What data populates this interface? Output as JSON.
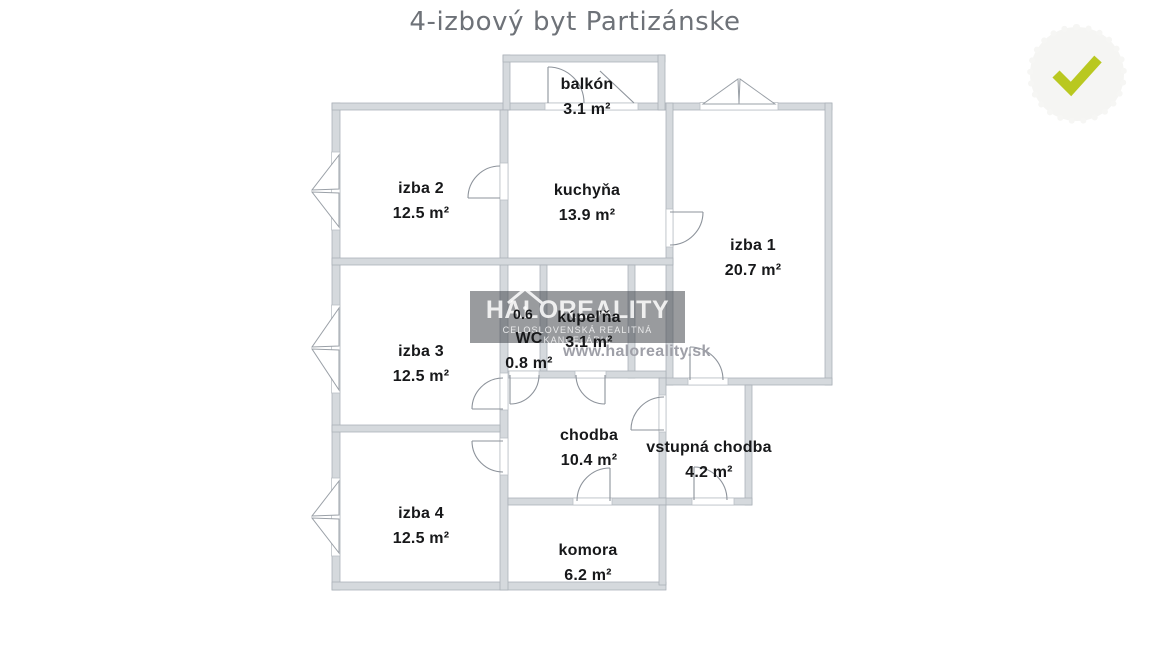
{
  "title": "4-izbový byt Partizánske",
  "title_color": "#6e7278",
  "plan": {
    "rooms": [
      {
        "name": "balkón",
        "area": "3.1 m²"
      },
      {
        "name": "izba 2",
        "area": "12.5 m²"
      },
      {
        "name": "kuchyňa",
        "area": "13.9 m²"
      },
      {
        "name": "izba 1",
        "area": "20.7 m²"
      },
      {
        "name": "izba 3",
        "area": "12.5 m²"
      },
      {
        "name": "WC",
        "area": "0.8 m²"
      },
      {
        "name": "kúpeľňa",
        "area": "3.1 m²"
      },
      {
        "name": "chodba",
        "area": "10.4 m²"
      },
      {
        "name": "vstupná chodba",
        "area": "4.2 m²"
      },
      {
        "name": "izba 4",
        "area": "12.5 m²"
      },
      {
        "name": "komora",
        "area": "6.2 m²"
      }
    ],
    "extra_labels": {
      "shaft_area": "0.6"
    },
    "wall_fill": "#d5d9dd",
    "wall_edge": "#a9afb6",
    "symbol_line_color": "#8d939b",
    "label_color": "#17181a"
  },
  "watermark": {
    "brand": "HALOREALITY",
    "subtitle": "CELOSLOVENSKÁ REALITNÁ KANCELÁRIA",
    "url": "www.haloreality.sk",
    "icon": "house-icon",
    "box_color": "rgba(70,72,78,0.55)",
    "url_color": "#9fa0a8"
  },
  "badge": {
    "icon": "check-icon",
    "check_color": "#b9c820",
    "circle_color": "#f5f5f3"
  }
}
